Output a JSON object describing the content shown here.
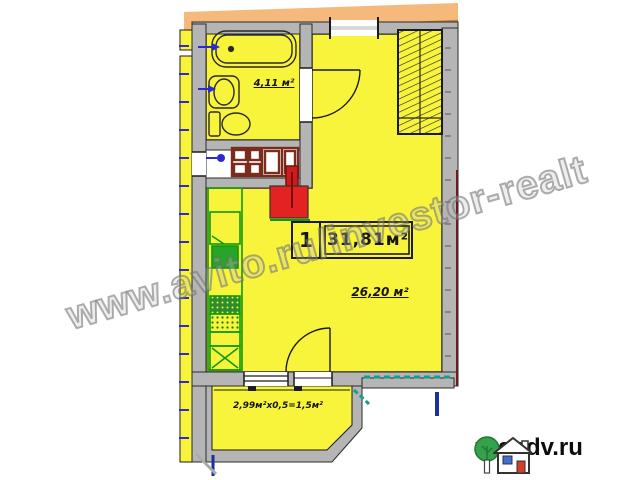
{
  "plan": {
    "bathroom": {
      "area_label": "4,11 м²"
    },
    "summary_box": {
      "number": "1",
      "total_area": "31,81м²"
    },
    "room": {
      "area_label": "26,20 м²"
    },
    "balcony": {
      "formula_label": "2,99м²х0,5=1,5м²"
    }
  },
  "watermark": {
    "text": "www.avito.ru/investor-realt"
  },
  "logo": {
    "site": "rosndv.ru"
  },
  "icons": {
    "bathtub": "bathtub-icon",
    "sink": "sink-icon",
    "toilet": "toilet-icon",
    "wardrobe": "wardrobe-hatch-icon",
    "vent_shaft": "vent-shaft-icon",
    "kitchen_counter": "kitchen-counter-icon",
    "door_swings": "door-swing-icon",
    "logo_tree": "tree-icon",
    "logo_house": "house-icon"
  },
  "colors": {
    "room_fill": "#f8f43c",
    "wall_fill": "#b5b5b5",
    "band_orange": "#f5b97c",
    "band_edge": "#c97f3e",
    "vent_red": "#e32222",
    "kitchen_green": "#0c9a10",
    "rail_teal": "#12a08a",
    "mark_blue": "#2a2ace",
    "bar_blue": "#1b2f9e",
    "cabinet_brown": "#7b2c1c",
    "logo_green": "#35a14a",
    "logo_window": "#3f6fd0",
    "logo_door": "#d23f2a"
  }
}
